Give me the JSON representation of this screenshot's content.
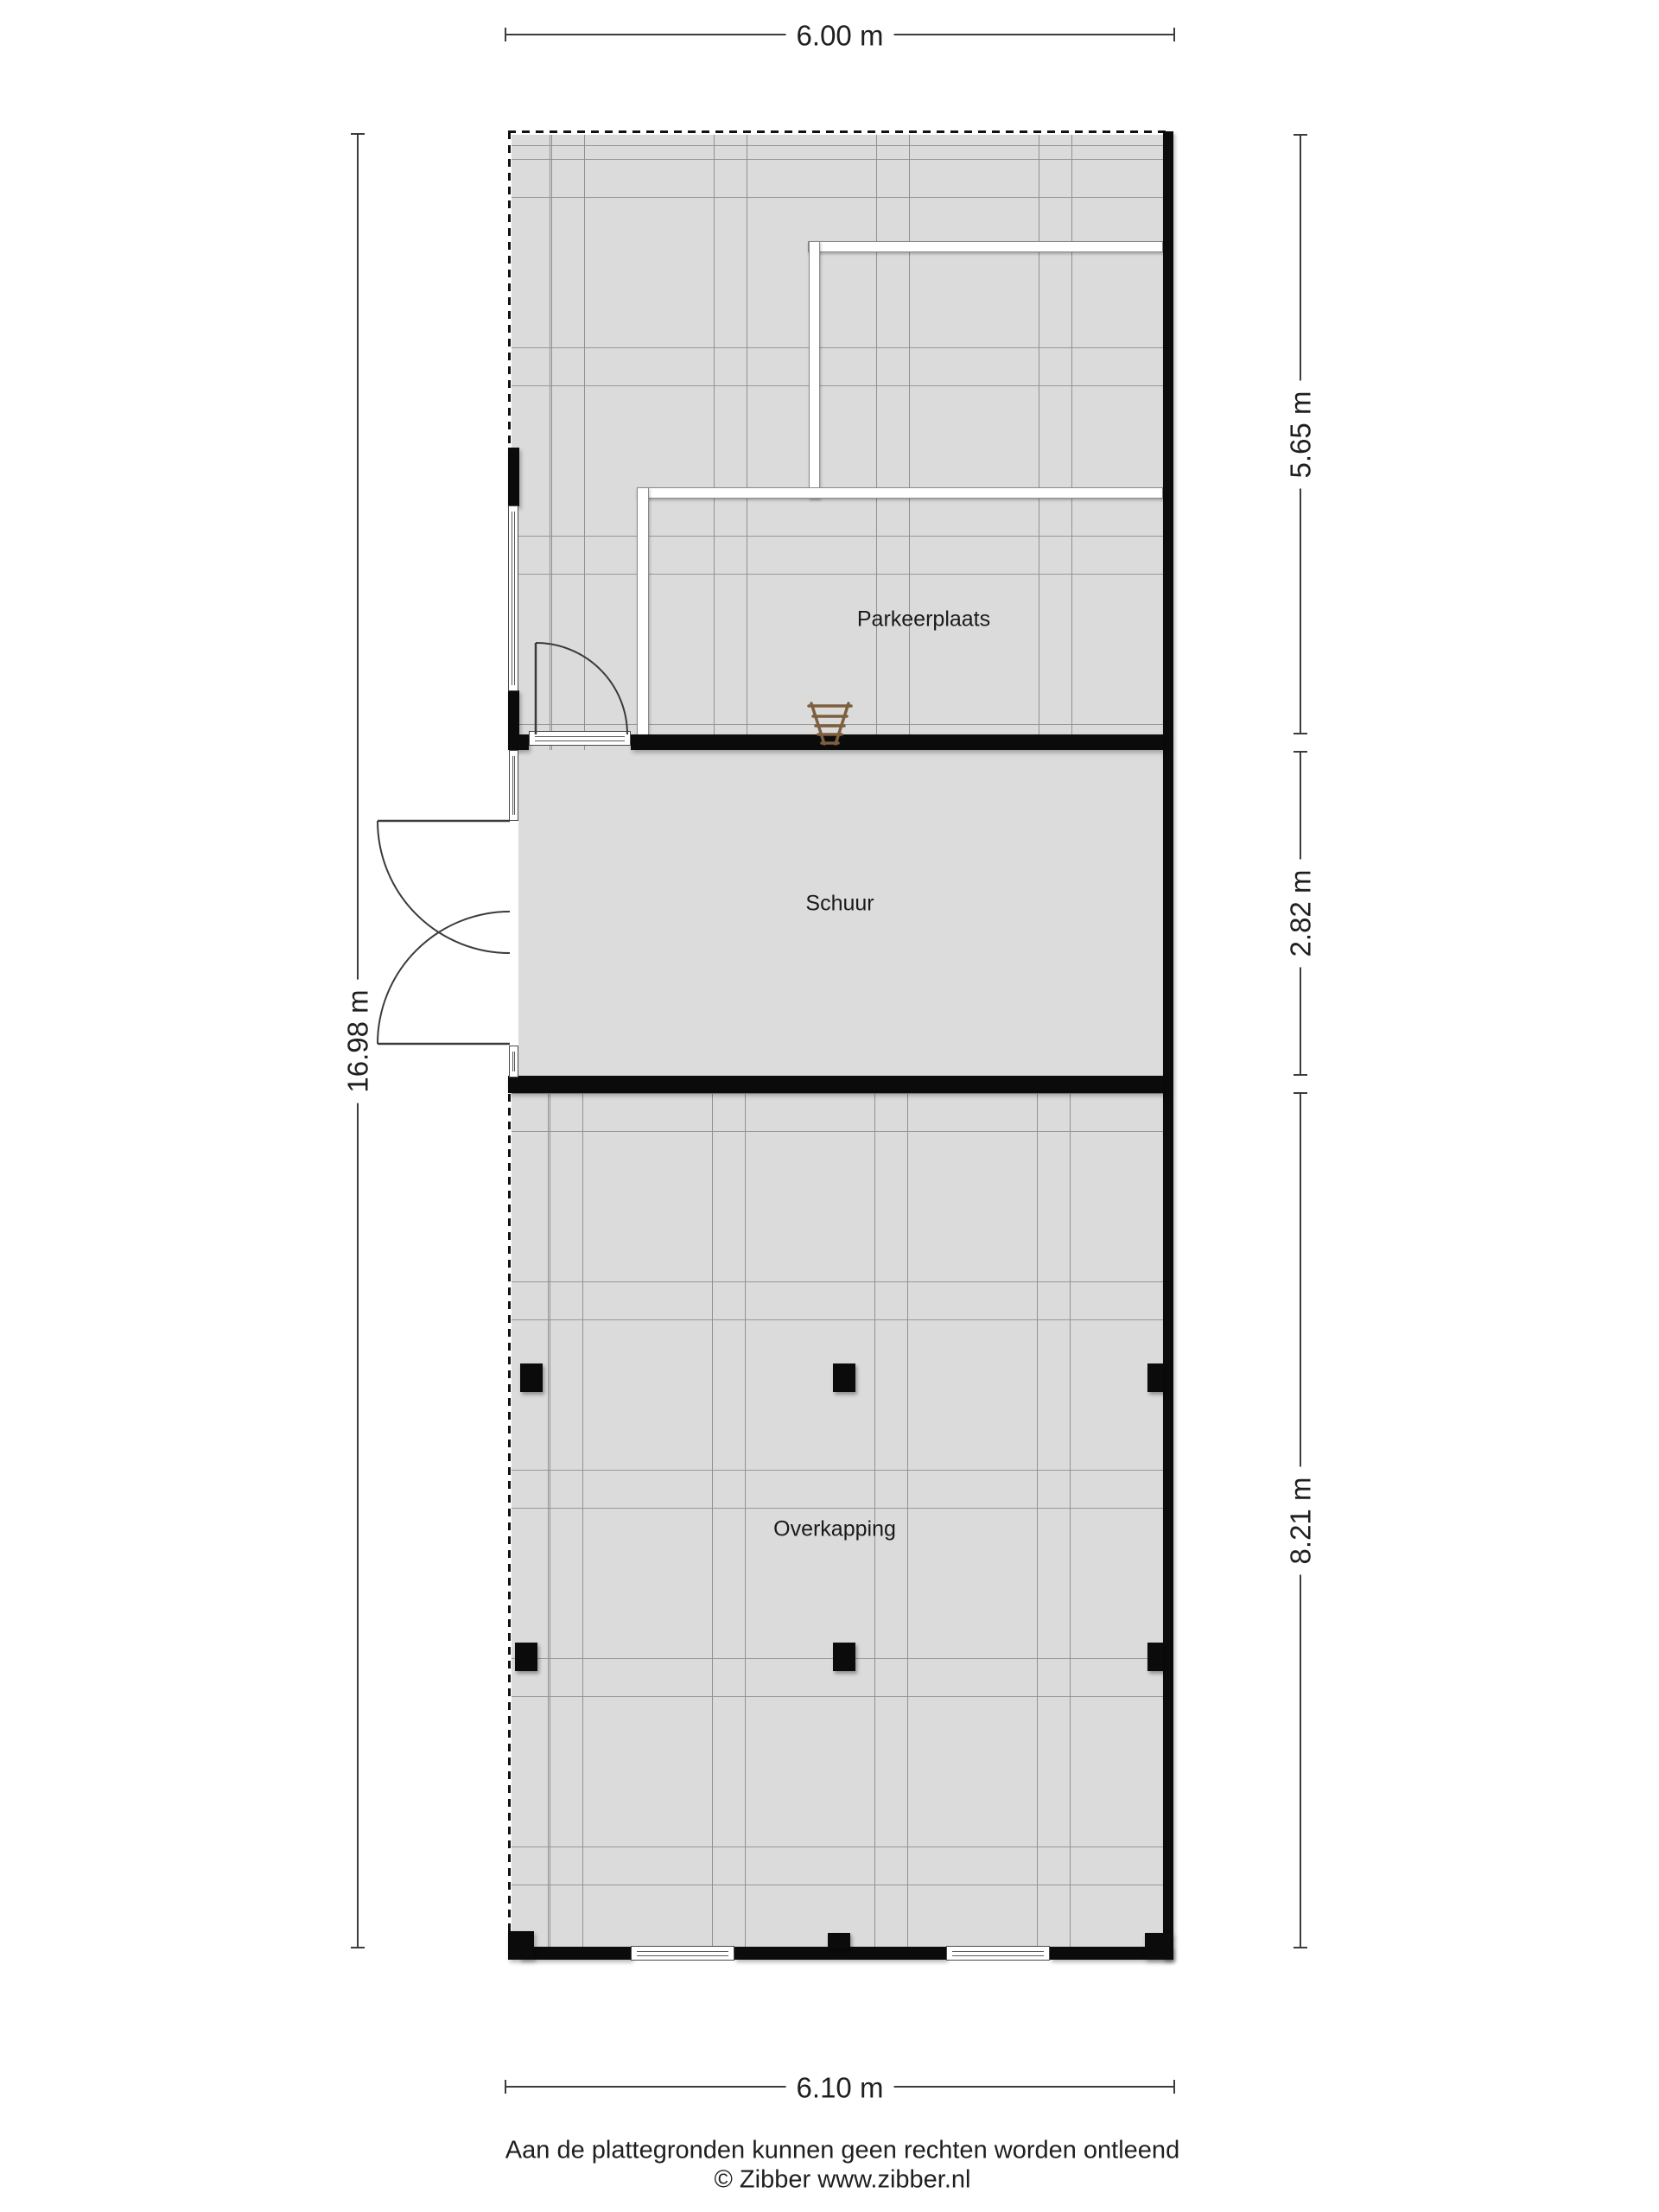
{
  "rooms": [
    {
      "name": "Parkeerplaats"
    },
    {
      "name": "Schuur"
    },
    {
      "name": "Overkapping"
    }
  ],
  "dimensions": {
    "top": "6.00 m",
    "bottom": "6.10 m",
    "left": "16.98 m",
    "right": [
      "5.65 m",
      "2.82 m",
      "8.21 m"
    ]
  },
  "footer": {
    "disclaimer": "Aan de plattegronden kunnen geen rechten worden ontleend",
    "credit": "© Zibber www.zibber.nl"
  },
  "icons": {
    "chair": "chair-icon"
  },
  "colors": {
    "wall": "#0b0b0b",
    "floor": "#dbdbdb",
    "grid_line": "#939393",
    "dimension_line": "#3c3c3c",
    "chair": "#7d5f40",
    "background": "#ffffff"
  }
}
